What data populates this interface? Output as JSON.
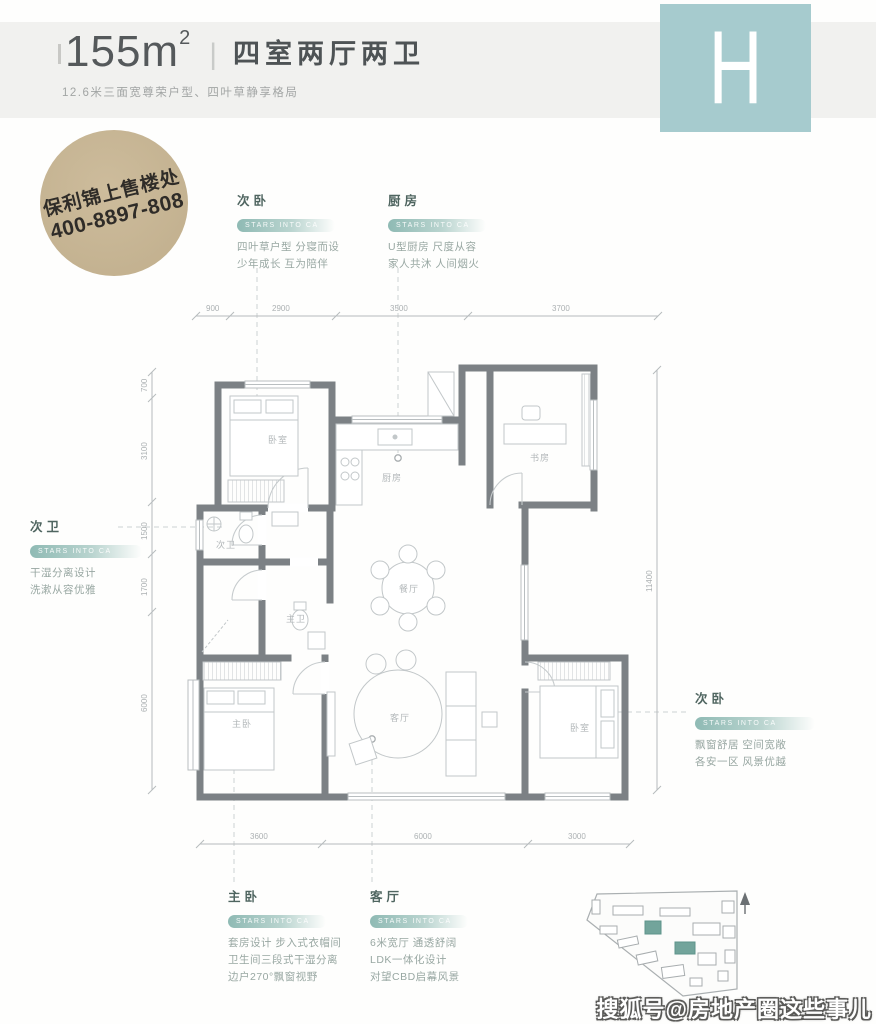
{
  "header": {
    "area_value": "155m",
    "area_superscript": "2",
    "divider": "|",
    "layout_title": "四室两厅两卫",
    "subtitle": "12.6米三面宽尊荣户型、四叶草静享格局",
    "unit_letter": "H"
  },
  "stamp": {
    "line1": "保利锦上售楼处",
    "line2": "400-8897-808"
  },
  "annotations": {
    "bedroom_top": {
      "title": "次卧",
      "pill": "STARS INTO CA",
      "line1": "四叶草户型 分寝而设",
      "line2": "少年成长 互为陪伴"
    },
    "kitchen": {
      "title": "厨房",
      "pill": "STARS INTO CA",
      "line1": "U型厨房 尺度从容",
      "line2": "家人共沐 人间烟火"
    },
    "bath": {
      "title": "次卫",
      "pill": "STARS INTO CA",
      "line1": "干湿分离设计",
      "line2": "洗漱从容优雅"
    },
    "bedroom_right": {
      "title": "次卧",
      "pill": "STARS INTO CA",
      "line1": "飘窗舒居 空间宽敞",
      "line2": "各安一区 风景优越"
    },
    "master": {
      "title": "主卧",
      "pill": "STARS INTO CA",
      "line1": "套房设计 步入式衣帽间",
      "line2": "卫生间三段式干湿分离",
      "line3": "边户270°飘窗视野"
    },
    "living": {
      "title": "客厅",
      "pill": "STARS INTO CA",
      "line1": "6米宽厅 通透舒阔",
      "line2": "LDK一体化设计",
      "line3": "对望CBD启幕风景"
    }
  },
  "floorplan": {
    "room_labels": {
      "bedroom1": "卧室",
      "kitchen": "厨房",
      "study": "书房",
      "bath2": "次卫",
      "bath1": "主卫",
      "dining": "餐厅",
      "master": "主卧",
      "living": "客厅",
      "bedroom3": "卧室"
    },
    "dims_top": [
      "900",
      "2900",
      "3500",
      "3700"
    ],
    "dims_bottom": [
      "3600",
      "6000",
      "3000"
    ],
    "dims_left": [
      "700",
      "3100",
      "1500",
      "1700",
      "6000"
    ],
    "dims_right": [
      "11400"
    ]
  },
  "watermark": "搜狐号@房地产圈这些事儿",
  "colors": {
    "accent_teal": "#a6cbce",
    "stamp_tan": "#c5b392",
    "wall_gray": "#7c8185",
    "pill_teal": "#8fbab4",
    "site_highlight": "#72a49b"
  }
}
